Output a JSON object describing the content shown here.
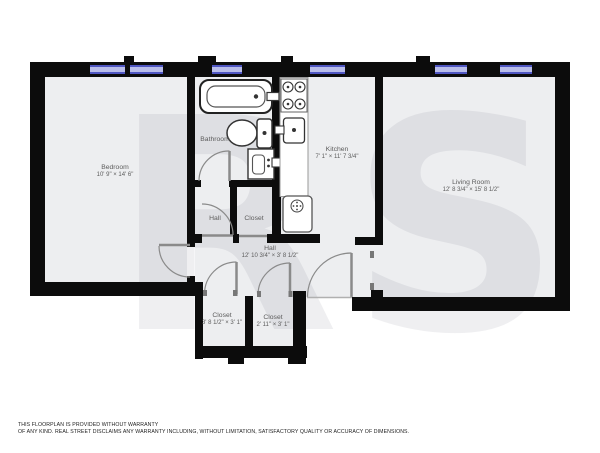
{
  "watermark": "RS",
  "rooms": {
    "bedroom": {
      "name": "Bedroom",
      "dims": "10' 9\" × 14' 6\""
    },
    "bathroom": {
      "name": "Bathroom"
    },
    "kitchen": {
      "name": "Kitchen",
      "dims": "7' 1\" × 11' 7 3/4\""
    },
    "living_room": {
      "name": "Living Room",
      "dims": "12' 8 3/4\" × 15' 8 1/2\""
    },
    "hall_small": {
      "name": "Hall"
    },
    "closet_upper": {
      "name": "Closet"
    },
    "hall_main": {
      "name": "Hall",
      "dims": "12' 10 3/4\" × 3' 8 1/2\""
    },
    "closet_bottom_left": {
      "name": "Closet",
      "dims": "3' 8 1/2\" × 3' 1\""
    },
    "closet_bottom_right": {
      "name": "Closet",
      "dims": "2' 11\" × 3' 1\""
    }
  },
  "fixtures": [
    "bathtub",
    "toilet",
    "vanity-sink",
    "stove",
    "kitchen-sink",
    "kitchen-counter",
    "washer"
  ],
  "colors": {
    "wall": "#0c0c0c",
    "floor": "#edeef0",
    "window_frame": "#4f56c2",
    "window_glass": "#b9bdea",
    "door": "#8a8a8a",
    "label_text": "#5c5c5c"
  },
  "disclaimer": {
    "line1": "THIS FLOORPLAN IS PROVIDED WITHOUT WARRANTY",
    "line2": "OF ANY KIND. REAL STREET DISCLAIMS ANY WARRANTY INCLUDING, WITHOUT LIMITATION, SATISFACTORY QUALITY OR ACCURACY OF DIMENSIONS."
  }
}
